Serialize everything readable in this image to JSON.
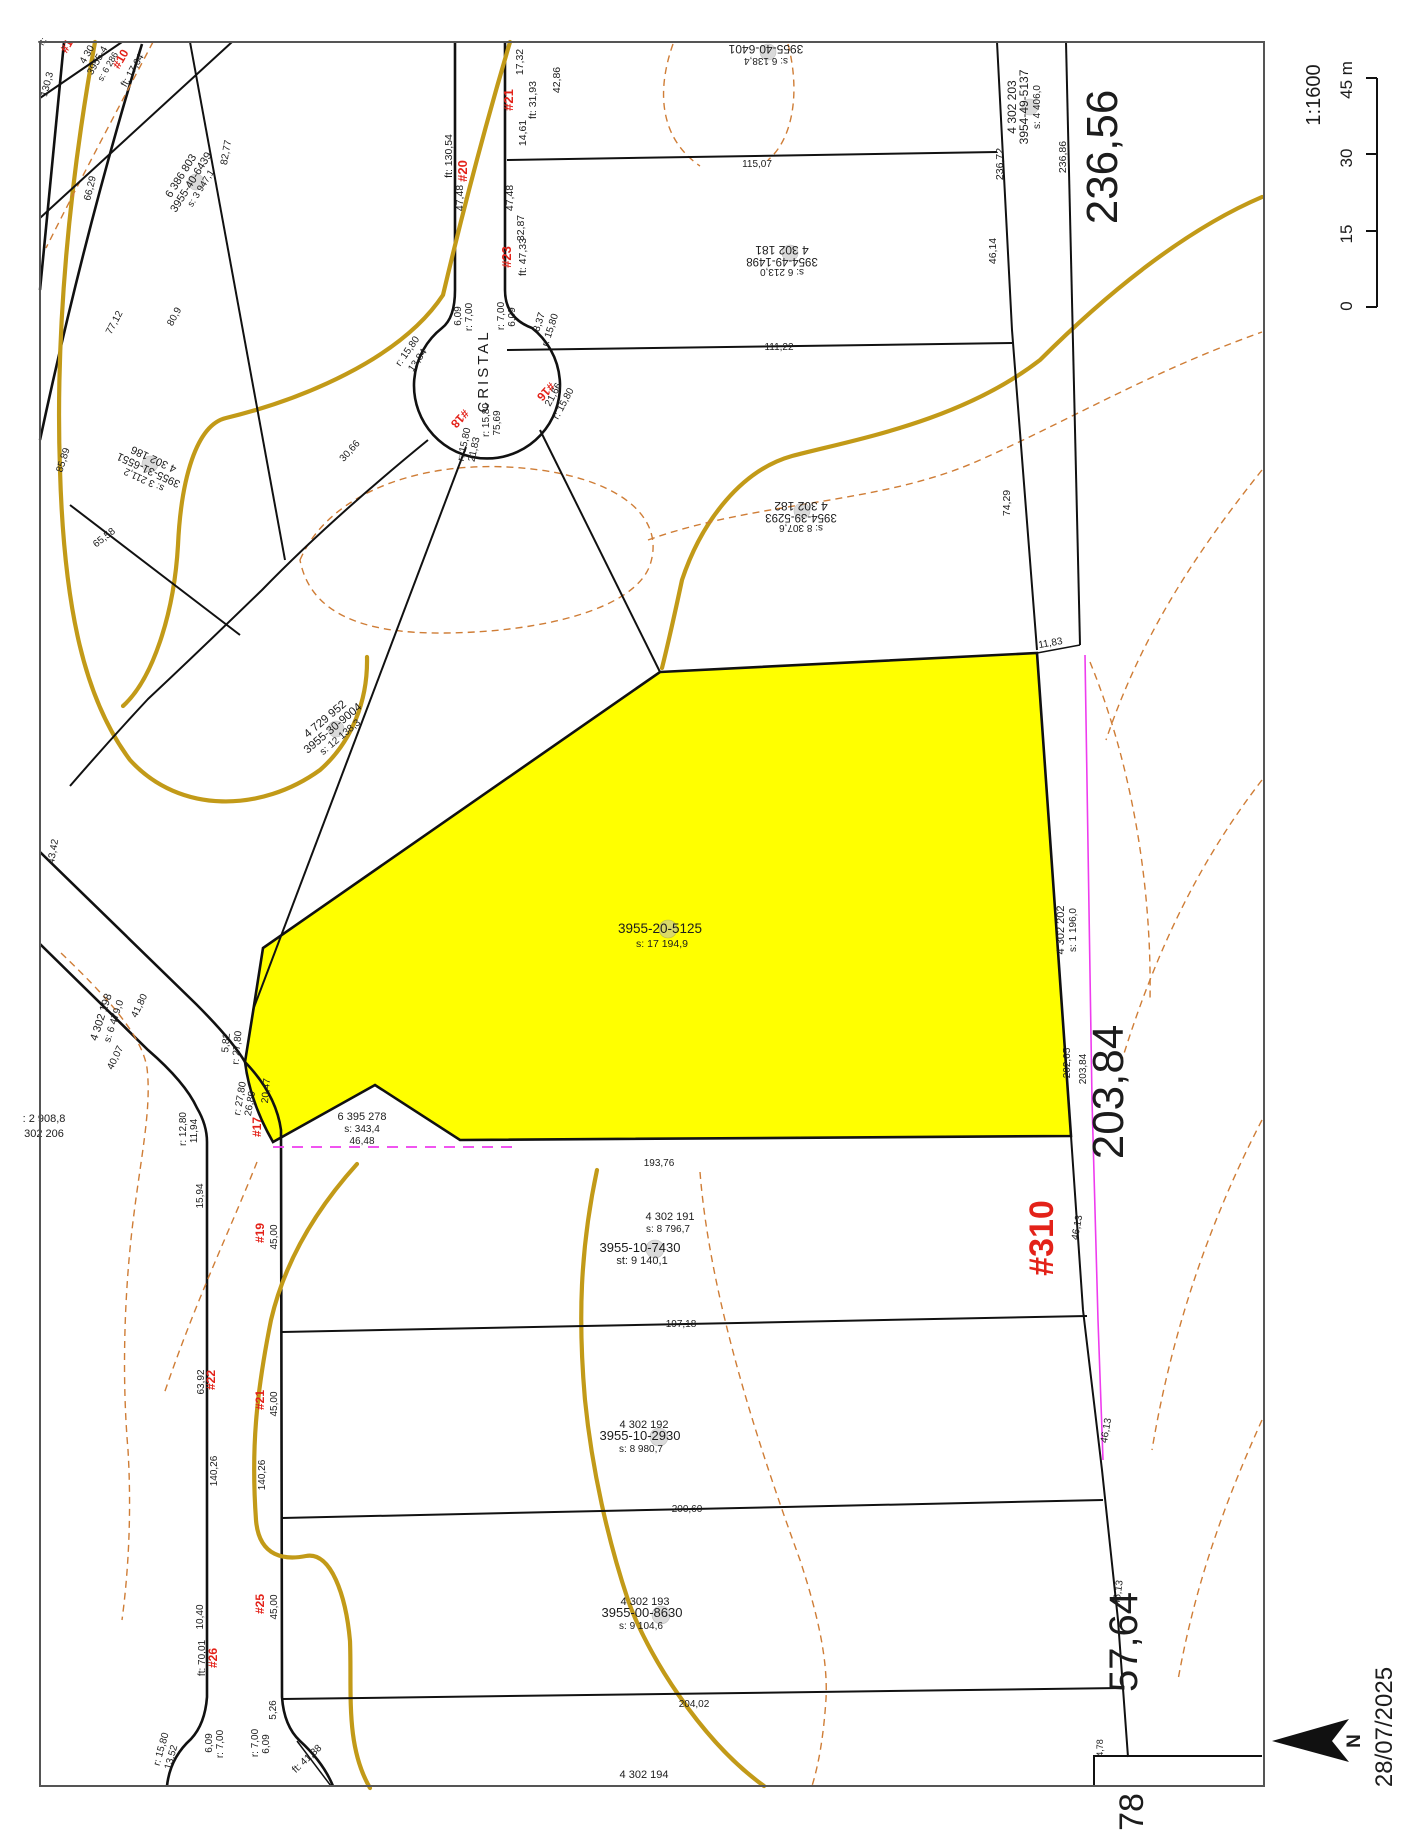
{
  "map": {
    "scale_ratio": "1:1600",
    "scale_ticks": [
      "0",
      "15",
      "30",
      "45 m"
    ],
    "date": "28/07/2025",
    "north": "N"
  },
  "street": {
    "name": "CRISTAL"
  },
  "selected": {
    "id": "3955-20-5125",
    "area": "s: 17 194,9",
    "street_no": "#310"
  },
  "big": {
    "right_top": "236,56",
    "right_mid": "203,84",
    "right_low": "57,64",
    "corner": "78"
  },
  "parcels": {
    "p6401": {
      "a": "3955-40-6401",
      "b": "s: 6 138,4"
    },
    "p181": {
      "a": "4 302 181",
      "b": "3954-49-1498",
      "c": "s: 6 213,0"
    },
    "p182": {
      "a": "4 302 182",
      "b": "3954-39-5293",
      "c": "s: 8 307,6"
    },
    "p203": {
      "a": "4 302 203",
      "b": "3954-49-5137",
      "c": "s: 4 406,0"
    },
    "p202": {
      "a": "4 302 202",
      "b": "s: 1 196,0"
    },
    "p186": {
      "a": "4 302 186",
      "b": "3955-31-6551",
      "c": "s: 3 211,2"
    },
    "p6386": {
      "a": "6 386 803",
      "b": "3955-40-6439",
      "c": "s: 3 947,1"
    },
    "p4729": {
      "a": "4 729 952",
      "b": "3955-30-9004",
      "c": "s: 12 138,3"
    },
    "p198": {
      "a": "4 302 198",
      "b": "s: 6 479,0"
    },
    "p206": {
      "a": ": 2 908,8",
      "b": "302 206"
    },
    "p278": {
      "a": "6 395 278",
      "b": "s: 343,4",
      "c": "46,48"
    },
    "p191": {
      "a": "4 302 191",
      "b": "s: 8 796,7",
      "c": "3955-10-7430",
      "d": "st: 9 140,1"
    },
    "p192": {
      "a": "4 302 192",
      "b": "3955-10-2930",
      "c": "s: 8 980,7"
    },
    "p193": {
      "a": "4 302 193",
      "b": "3955-00-8630",
      "c": "s: 9 104,6"
    },
    "p194": {
      "a": "4 302 194"
    },
    "pcorner": {
      "a": "4 30",
      "b": "3955-4",
      "c": "s: 6 286"
    }
  },
  "nums": {
    "n1": "#1",
    "n10": "#10",
    "n16": "#16",
    "n17": "#17",
    "n18": "#18",
    "n19": "#19",
    "n20": "#20",
    "n21": "#21",
    "n21b": "#21",
    "n22": "#22",
    "n23": "#23",
    "n25": "#25",
    "n26": "#26"
  },
  "dims": {
    "d17_32": "17,32",
    "d31_93": "ft: 31,93",
    "d42_86": "42,86",
    "d14_61": "14,61",
    "d130_54": "ft: 130,54",
    "d47_48a": "47,48",
    "d47_48b": "47,48",
    "d32_87": "32,87",
    "d47_33": "ft: 47,33",
    "d115": "115,07",
    "d111": "111,22",
    "d236_72": "236,72",
    "d236_86": "236,86",
    "d46_14": "46,14",
    "d74_29": "74,29",
    "d11_83": "11,83",
    "d202_65": "202,65",
    "d203_84": "203,84",
    "d46_13a": "46,13",
    "d46_13b": "46,13",
    "d46_13c": "46,13",
    "d4_78": "4,78",
    "d6_09a": "6,09",
    "d6_09b": "6,09",
    "d6_09c": "6,09",
    "d6_09d": "6,09",
    "r7a": "r: 7,00",
    "r7b": "r: 7,00",
    "r7c": "r: 7,00",
    "r7d": "r: 7,00",
    "d8_37": "8,37",
    "r15c": "r: 15,80",
    "r15d": "r: 15,80",
    "d13_84": "13,84",
    "d21_66": "21,66",
    "r15e": "r: 15,80",
    "r15f": "r: 15,80",
    "d75_69": "75,69",
    "r15g": "r: 15,80",
    "d21_83": "21,83",
    "d30_66": "30,66",
    "dft": "ft:",
    "d17_64": "ft: 17,64",
    "d130_3": "130,3",
    "d66_29": "66,29",
    "d82_77": "82,77",
    "d77_12": "77,12",
    "d80_9": "80,9",
    "d85_89": "85,89",
    "d43_42": "43,42",
    "d65_58": "65,58",
    "d5_82": "5,82",
    "r2780a": "r: 27,80",
    "d20_47": "20,47",
    "r2780b": "r: 27,80",
    "d26_89": "26,89",
    "r1280": "r: 12,80",
    "d11_94": "11,94",
    "d41_80": "41,80",
    "d40_07": "40,07",
    "d15_94": "15,94",
    "d45a": "45,00",
    "d45b": "45,00",
    "d45c": "45,00",
    "d63_92": "63,92",
    "d140a": "140,26",
    "d140b": "140,26",
    "d10_40": "10,40",
    "d70_01": "ft: 70,01",
    "d5_26": "5,26",
    "r15h": "r: 15,80",
    "d13_52": "13,52",
    "d41_38": "ft: 41,38",
    "d193_76": "193,76",
    "d197": "197,18",
    "d200": "200,60",
    "d204": "204,02"
  },
  "colors": {
    "highlight": "#ffff00",
    "contour": "#cf7d36",
    "utility": "#c29a18",
    "magenta": "#ee3cee",
    "street_no_red": "#e32219"
  }
}
